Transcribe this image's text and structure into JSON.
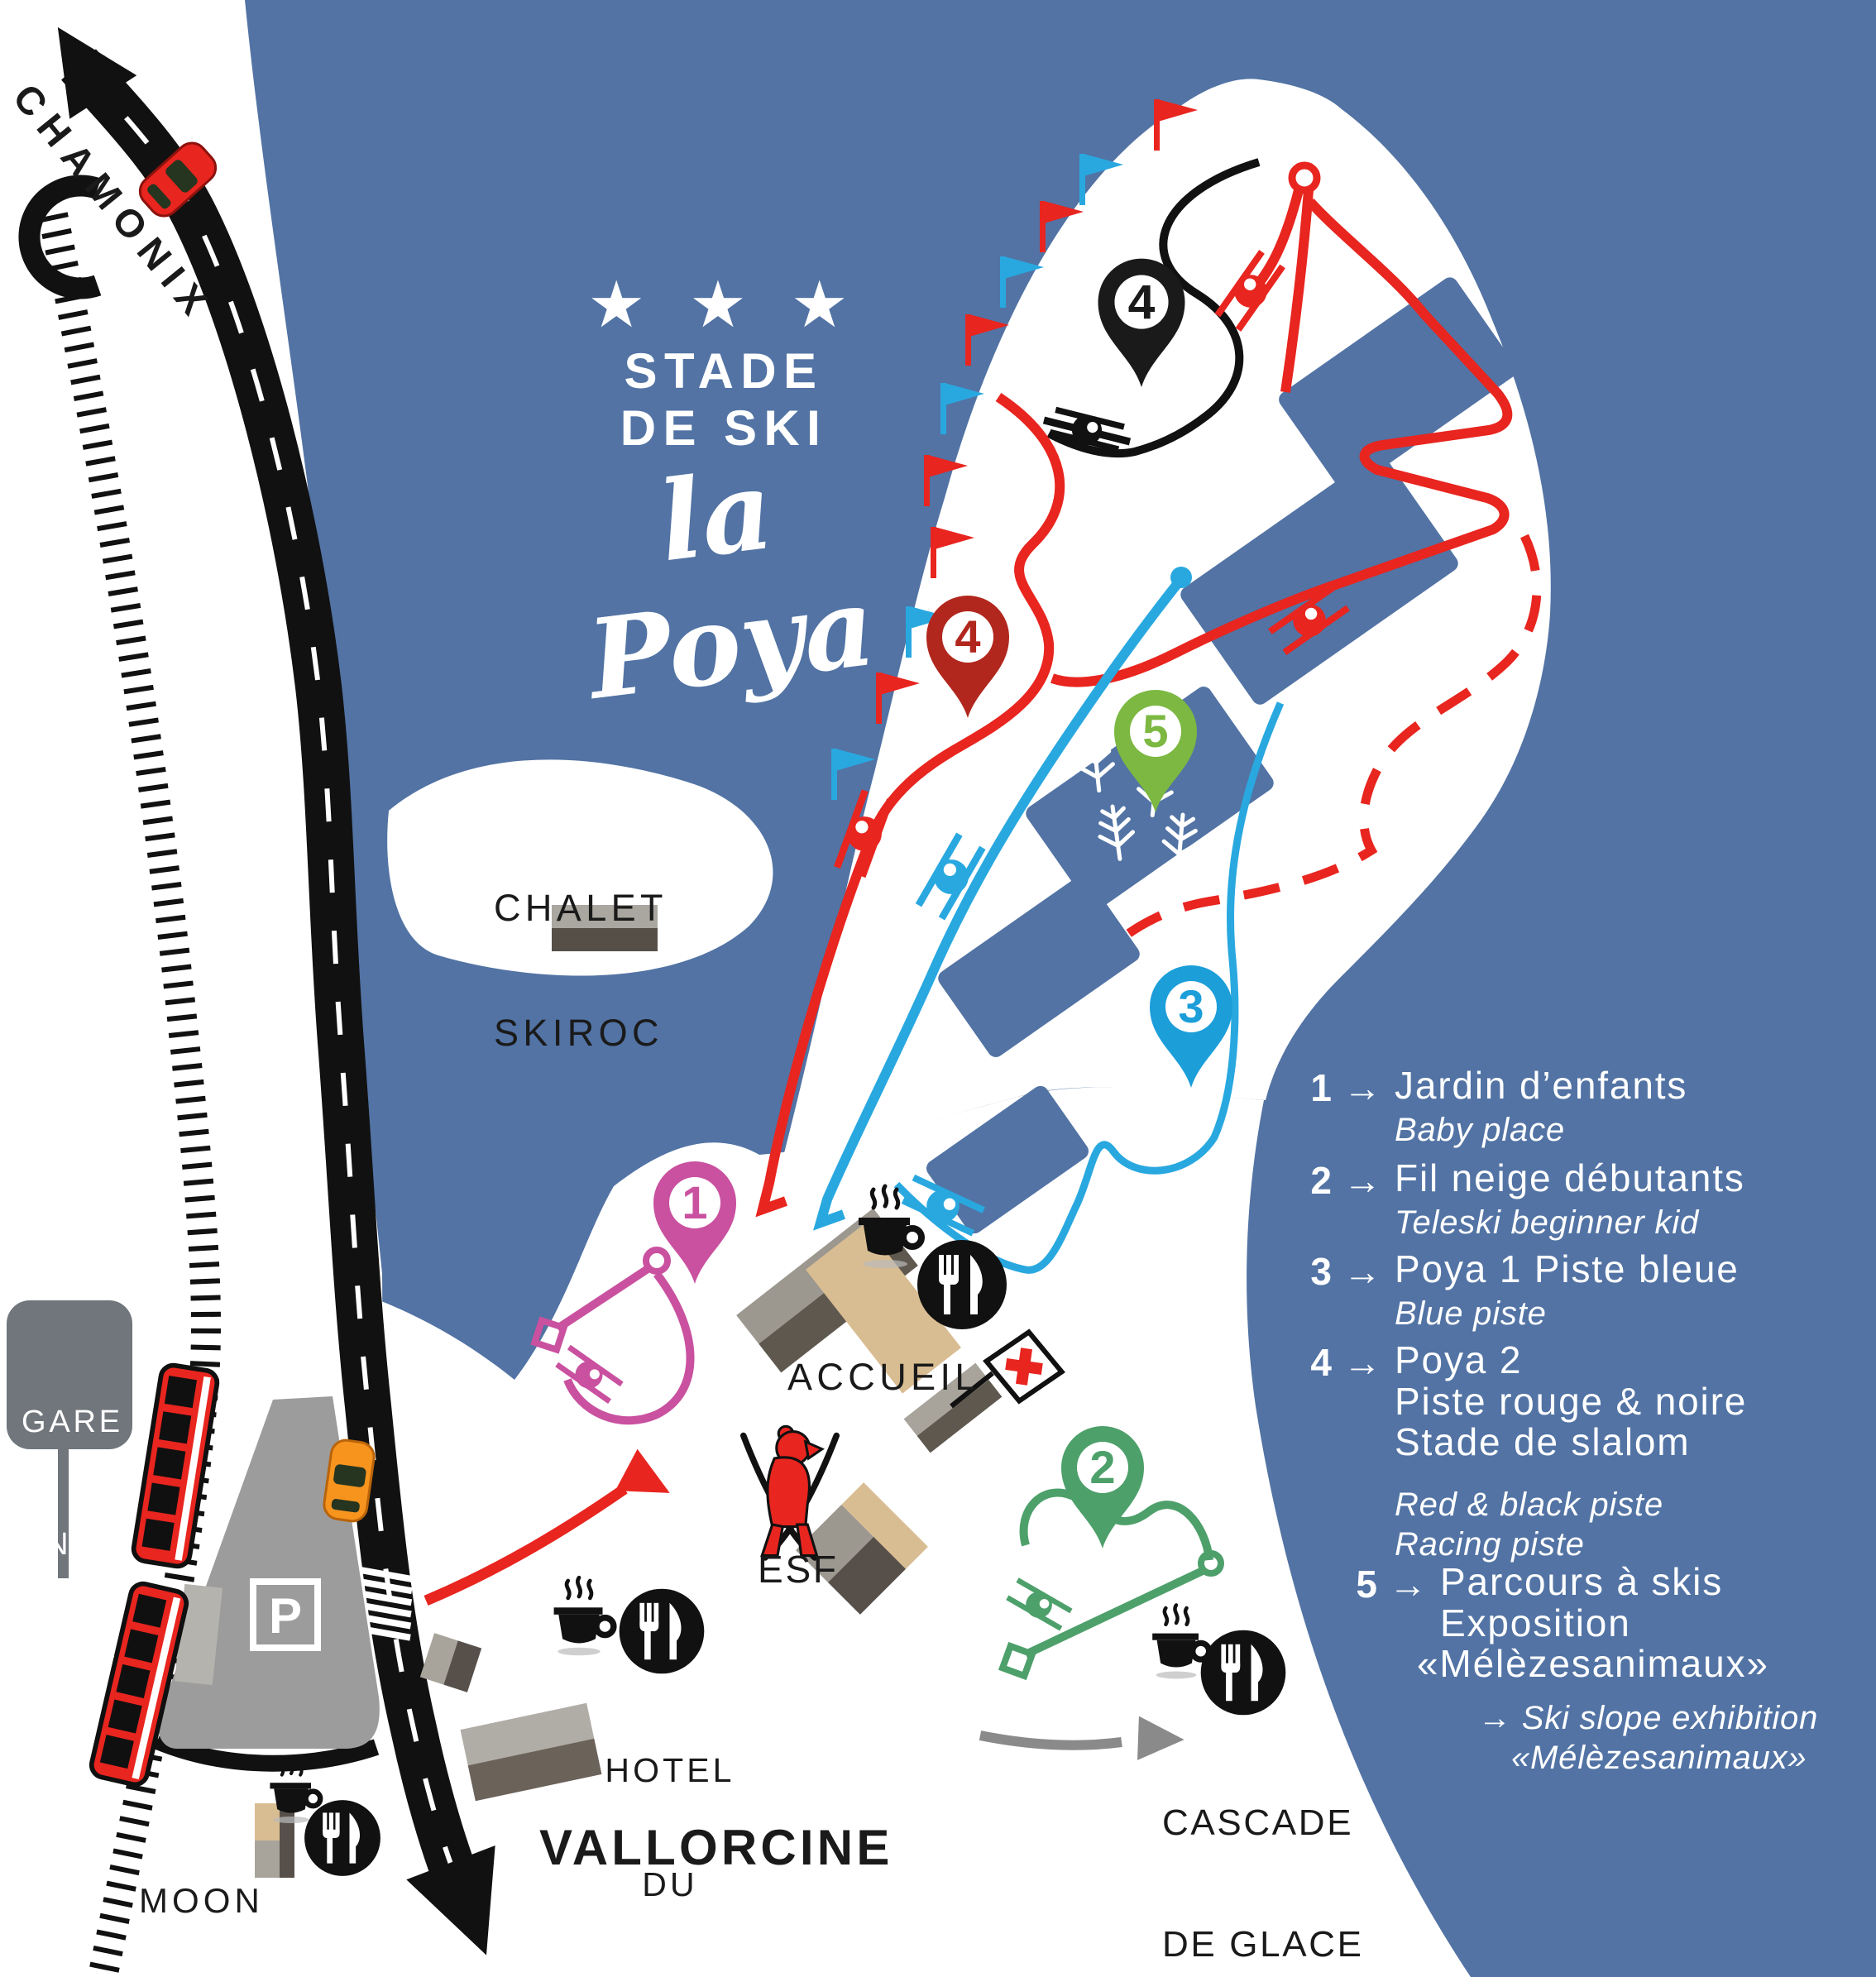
{
  "title": {
    "stars": "★ ★ ★",
    "line1": "STADE",
    "line2": "DE SKI",
    "script": "la Poya"
  },
  "directions": {
    "north": "CHAMONIX",
    "south": "VALLORCINE"
  },
  "sign_gare": {
    "line1": "GARE",
    "line2": "SNCF",
    "line3": "BUET"
  },
  "parking": {
    "label": "P"
  },
  "places": {
    "chalet": {
      "line1": "CHALET",
      "line2": "SKIROC"
    },
    "accueil": "ACCUEIL",
    "esf": "ESF",
    "hotel": {
      "line1": "HOTEL",
      "line2": "DU",
      "line3": "BUET"
    },
    "moontine": {
      "line1": "MOON",
      "line2": "TINE"
    },
    "cascade": {
      "line1": "CASCADE",
      "line2": "DE GLACE"
    }
  },
  "markers": [
    {
      "num": "1",
      "color": "#c9519f"
    },
    {
      "num": "2",
      "color": "#4ea06b"
    },
    {
      "num": "3",
      "color": "#1c9ed9"
    },
    {
      "num": "4",
      "color": "#b2271d"
    },
    {
      "num": "4",
      "color": "#1a1a1a"
    },
    {
      "num": "5",
      "color": "#7cb842"
    }
  ],
  "legend": {
    "items": [
      {
        "num": "1",
        "arrow": "→",
        "fr": [
          "Jardin d’enfants"
        ],
        "en": [
          "Baby place"
        ]
      },
      {
        "num": "2",
        "arrow": "→",
        "fr": [
          "Fil neige débutants"
        ],
        "en": [
          "Teleski beginner kid"
        ]
      },
      {
        "num": "3",
        "arrow": "→",
        "fr": [
          "Poya 1 Piste bleue"
        ],
        "en": [
          "Blue piste"
        ]
      },
      {
        "num": "4",
        "arrow": "→",
        "fr": [
          "Poya 2",
          "Piste rouge & noire",
          "Stade de slalom"
        ],
        "en": [
          "Red & black piste",
          "Racing piste"
        ]
      },
      {
        "num": "5",
        "arrow": "→",
        "fr": [
          "Parcours à skis",
          "Exposition",
          "«Mélèzesanimaux»"
        ],
        "en": [
          "→ Ski slope exhibition",
          "«Mélèzesanimaux»"
        ]
      }
    ]
  },
  "colors": {
    "background": "#5273a4",
    "snow": "#ffffff",
    "road": "#111111",
    "red": "#e8251f",
    "dark_red": "#b2271d",
    "blue": "#29a8e0",
    "pink": "#c9519f",
    "green": "#4ea06b",
    "lime": "#7cb842",
    "gray_sign": "#70767c",
    "gray_parking": "#9c9c9c",
    "tan": "#d9bd92"
  }
}
